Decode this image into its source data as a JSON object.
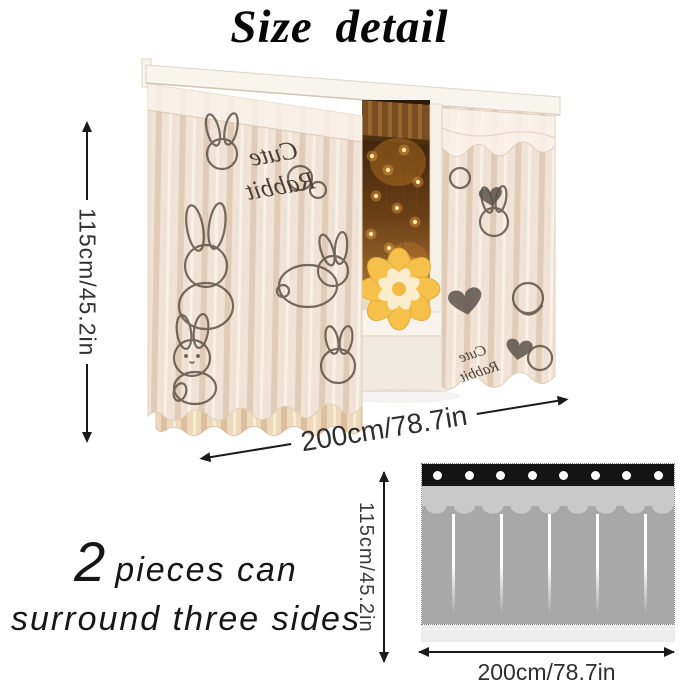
{
  "title": "Size detail",
  "photo": {
    "height_label": "115cm/45.2in",
    "width_label": "200cm/78.7in",
    "fabric_script_line1": "Cute",
    "fabric_script_line2": "Rabbit"
  },
  "caption": {
    "count": "2",
    "line1": "pieces can",
    "line2": "surround three sides"
  },
  "diagram": {
    "height_label": "115cm/45.2in",
    "width_label": "200cm/78.7in",
    "grommet_count": 8
  },
  "colors": {
    "arrow_ink": "#1a1a1a",
    "diagram_header_strip": "#141414",
    "diagram_grommet": "#ffffff",
    "diagram_valance_gray": "#c9c9c9",
    "diagram_curtain_gray": "#a8a8a8",
    "diagram_base_strip": "#ededed",
    "fabric_cream": "#f0e3d5",
    "pattern_ink": "#564a3d",
    "fairy_light": "#ffcf6e"
  }
}
